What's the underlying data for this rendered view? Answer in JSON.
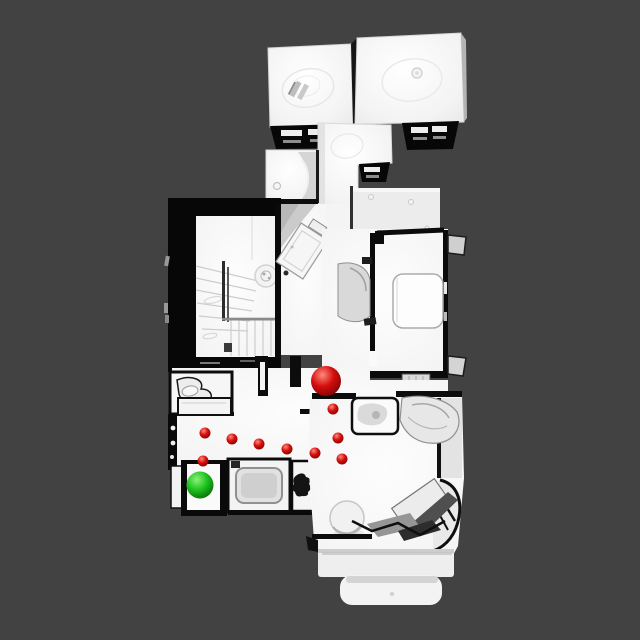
{
  "scene": {
    "description": "Top-down orthographic view of a 3D-scanned multi-room house mesh with navigation markers",
    "background_color": "#424242",
    "mesh": {
      "floor_color": "#f8f8f8",
      "wall_shadow_color": "#0a0a0a",
      "roof_block_color": "#f2f2f2",
      "upper_landing_color": "#ececec"
    }
  },
  "markers": {
    "agent": {
      "label": "current-position-sphere",
      "x": 326,
      "y": 381,
      "radius": 15,
      "color": "#d40e0e",
      "highlight": "#ff8a7a",
      "rim": "#6f0000"
    },
    "goal": {
      "label": "goal-sphere",
      "x": 200,
      "y": 485,
      "radius": 13.5,
      "color": "#1ec41e",
      "highlight": "#8df07e",
      "rim": "#035703"
    },
    "path": {
      "label": "path-waypoints",
      "color": "#d40e0e",
      "point_radius": 5.5,
      "points": [
        [
          333,
          409
        ],
        [
          338,
          438
        ],
        [
          342,
          459
        ],
        [
          315,
          453
        ],
        [
          287,
          449
        ],
        [
          259,
          444
        ],
        [
          232,
          439
        ],
        [
          205,
          433
        ],
        [
          203,
          461
        ]
      ]
    }
  }
}
